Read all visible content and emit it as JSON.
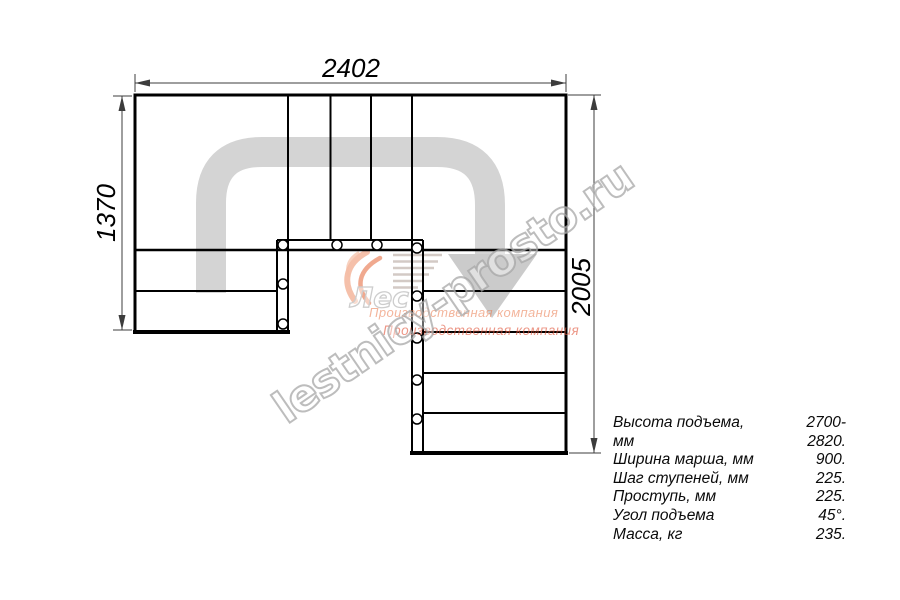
{
  "dimensions": {
    "width_top": "2402",
    "height_left": "1370",
    "height_right": "2005"
  },
  "specs": {
    "rows": [
      {
        "label": "Высота подъема, мм",
        "value": "2700-2820."
      },
      {
        "label": "Ширина марша, мм",
        "value": "900."
      },
      {
        "label": "Шаг ступеней, мм",
        "value": "225."
      },
      {
        "label": "Проступь, мм",
        "value": "225."
      },
      {
        "label": "Угол подъема",
        "value": "45°."
      },
      {
        "label": "Масса, кг",
        "value": "235."
      }
    ]
  },
  "watermark": {
    "site": "lestnicy-prosto.ru",
    "company_line1": "Производственная компания",
    "company_line2": "Производственная компания",
    "logo_text": "Лес"
  },
  "colors": {
    "drawing_line": "#000000",
    "dimension_line": "#3c3c3c",
    "direction_arrow": "#d4d4d4",
    "watermark_gray": "#a3a3a3",
    "logo_orange": "#e8784e",
    "logo_salmon": "#f0a382"
  }
}
